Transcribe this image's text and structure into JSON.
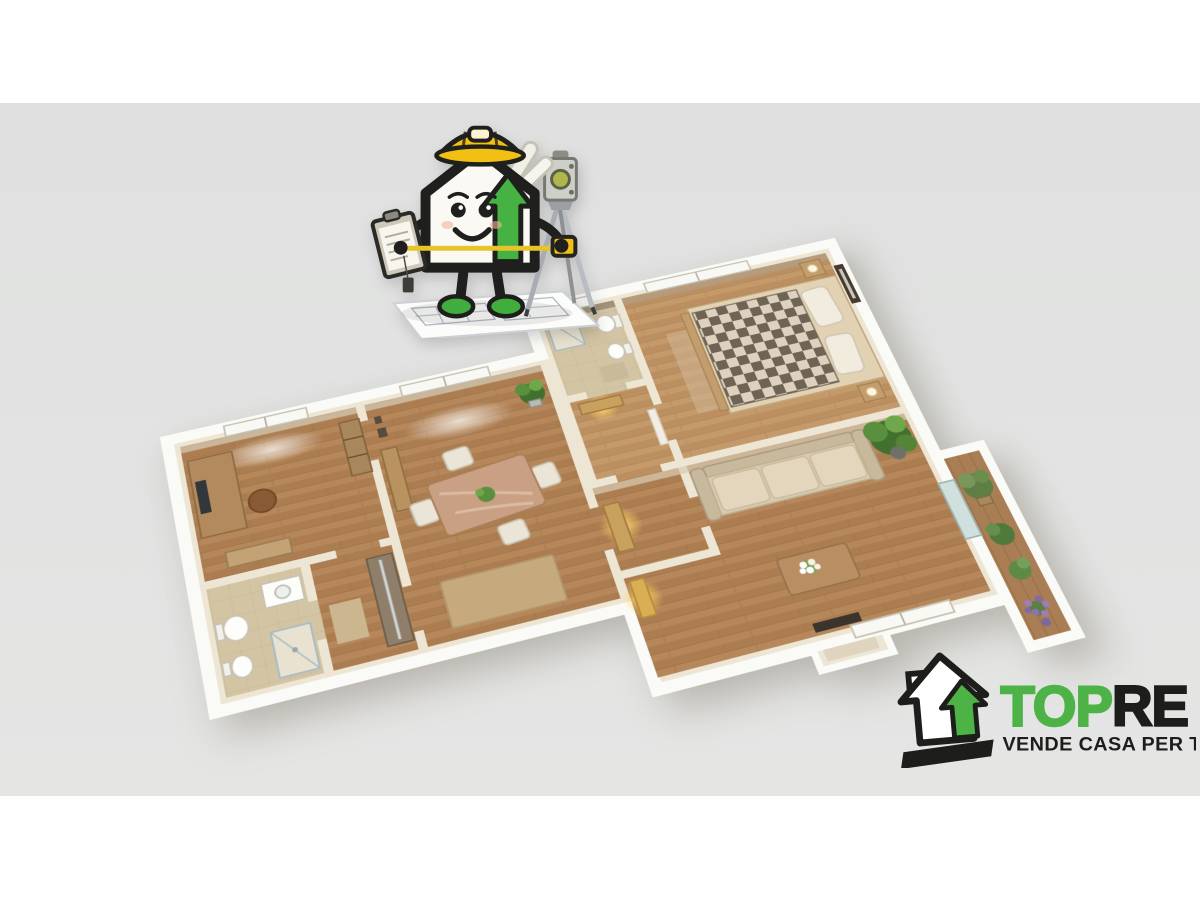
{
  "backdrop": {
    "page_color": "#ffffff",
    "band_color": "#e0e1e0"
  },
  "logo": {
    "brand_top": "TOP",
    "brand_re": "RE",
    "tagline": "VENDE CASA PER TE!",
    "green": "#4eb347",
    "black": "#1d1d1b"
  },
  "palette": {
    "wall_top": "#eee6d4",
    "wall_outer": "#fafaf7",
    "wood_floor": "#b5875a",
    "bedroom_floor": "#c59a6b",
    "tile_floor": "#d3c5a4",
    "bed_checker_dark": "#6f6354",
    "bed_checker_light": "#ddd2c0",
    "sofa_beige": "#d9cbb1",
    "plant_green": "#5a8f3d",
    "lavender": "#9b7fb6",
    "lamp_glow": "#ffd978",
    "mascot_hat_yellow": "#f2c012",
    "mascot_arrow_green": "#47b244",
    "mascot_shoe_green": "#3fae3c"
  },
  "floorplan": {
    "rooms": [
      "office",
      "bathroom",
      "closet-hall",
      "dining-room",
      "entrance-hall",
      "second-bathroom",
      "inner-hall",
      "bedroom",
      "living-room",
      "balcony"
    ]
  },
  "mascot": {
    "parts": [
      "house-body",
      "hard-hat",
      "headlamp",
      "smiling-face",
      "clipboard",
      "measuring-tape",
      "blueprint-rolls",
      "tripod-total-station",
      "blueprint-sheet",
      "green-shoes"
    ]
  }
}
